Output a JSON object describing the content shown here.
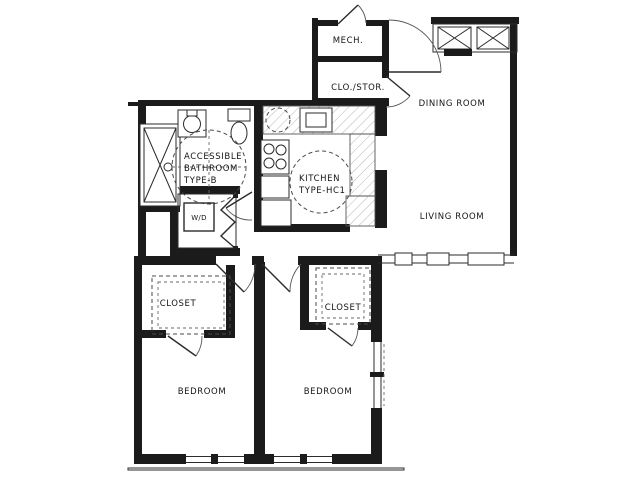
{
  "title": "Two-bedroom accessible apartment floor plan",
  "colors": {
    "background": "#ffffff",
    "wall": "#1b1b1b",
    "hatch": "#b5b5b5",
    "dashed_symbols": "#4a4a4a"
  },
  "rooms": {
    "mech": {
      "label": "MECH."
    },
    "clo_stor": {
      "label": "CLO./STOR."
    },
    "dining": {
      "label": "DINING ROOM"
    },
    "living": {
      "label": "LIVING ROOM"
    },
    "bathroom": {
      "line1": "ACCESSIBLE",
      "line2": "BATHROOM",
      "line3": "TYPE-B"
    },
    "kitchen": {
      "line1": "KITCHEN",
      "line2": "TYPE-HC1"
    },
    "laundry": {
      "label": "W/D"
    },
    "closet1": {
      "label": "CLOSET"
    },
    "closet2": {
      "label": "CLOSET"
    },
    "bedroom1": {
      "label": "BEDROOM"
    },
    "bedroom2": {
      "label": "BEDROOM"
    }
  }
}
